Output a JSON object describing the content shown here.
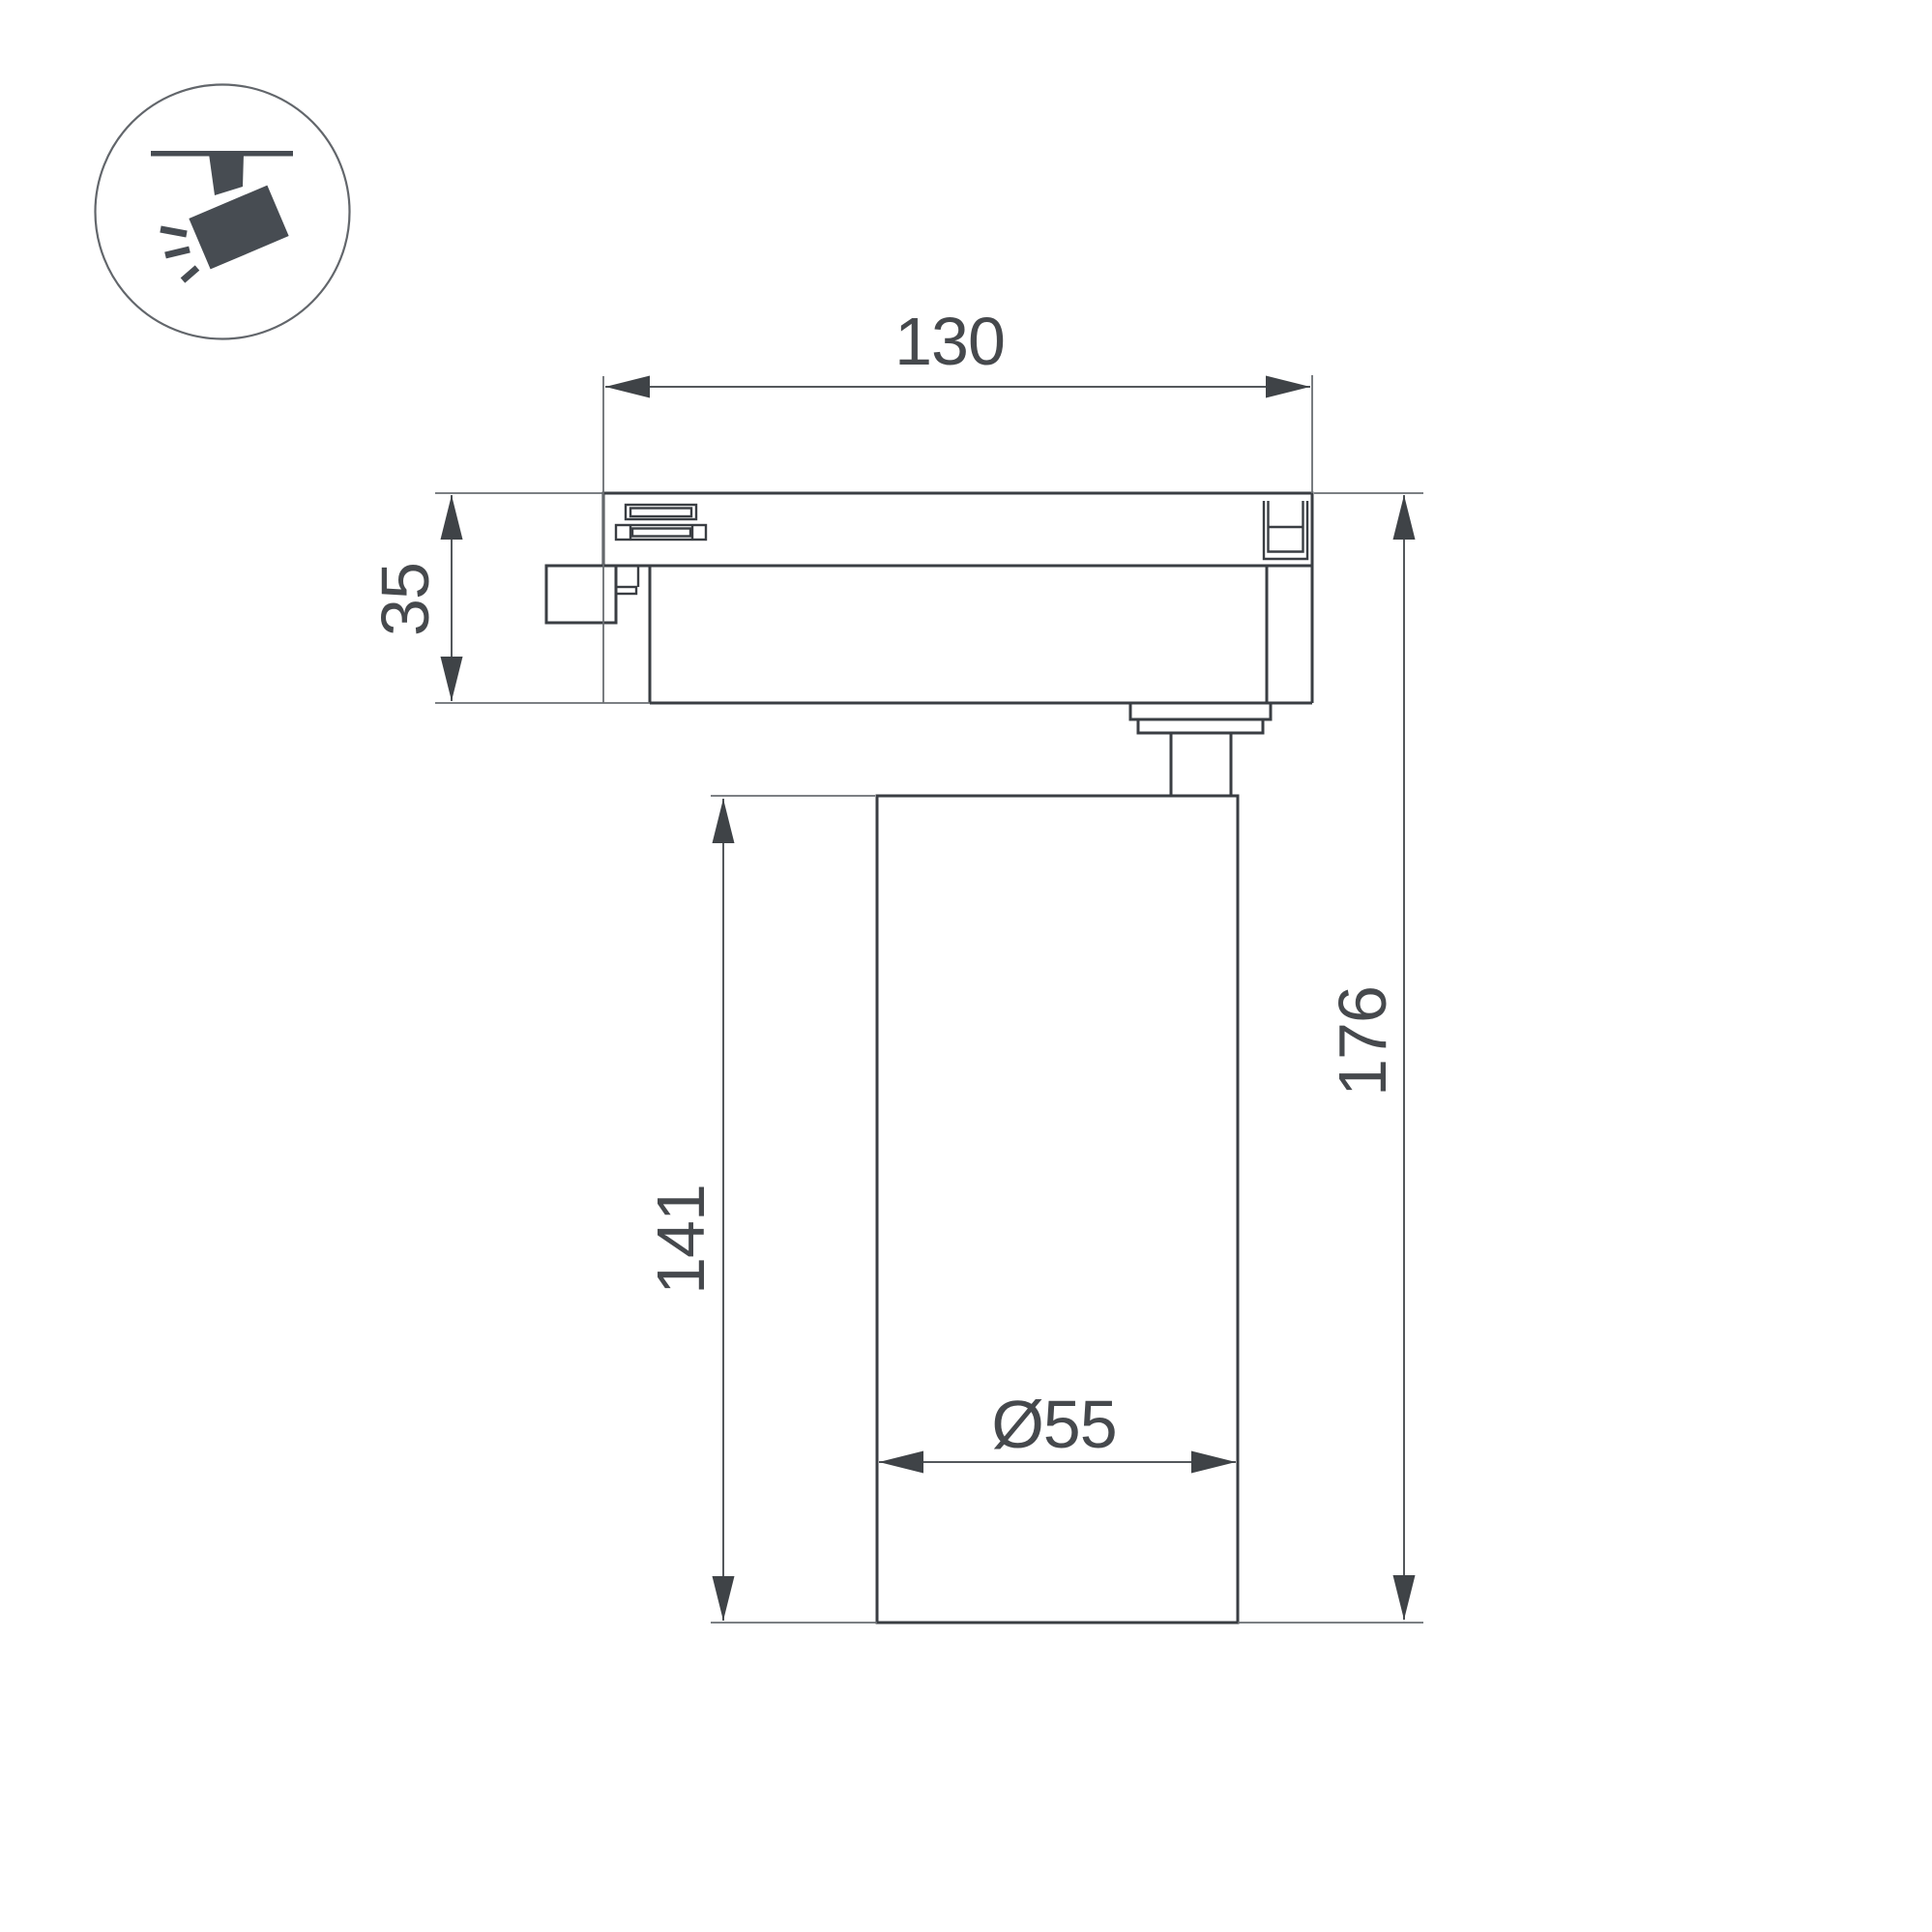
{
  "page": {
    "background": "#ffffff"
  },
  "icon": {
    "name": "track-spotlight-icon"
  },
  "dimensions": {
    "track_width": {
      "text": "130",
      "value": 130
    },
    "adapter_height": {
      "text": "35",
      "value": 35
    },
    "body_height": {
      "text": "141",
      "value": 141
    },
    "total_height": {
      "text": "176",
      "value": 176
    },
    "body_diameter": {
      "text": "Ø55",
      "value": 55
    }
  },
  "colors": {
    "outline": "#3a3e43",
    "dimension_line": "#54585c",
    "extension_line": "#6a6e72",
    "text": "#46494d",
    "icon_fill": "#474c52",
    "icon_circle_stroke": "#62666b",
    "background": "#ffffff"
  }
}
